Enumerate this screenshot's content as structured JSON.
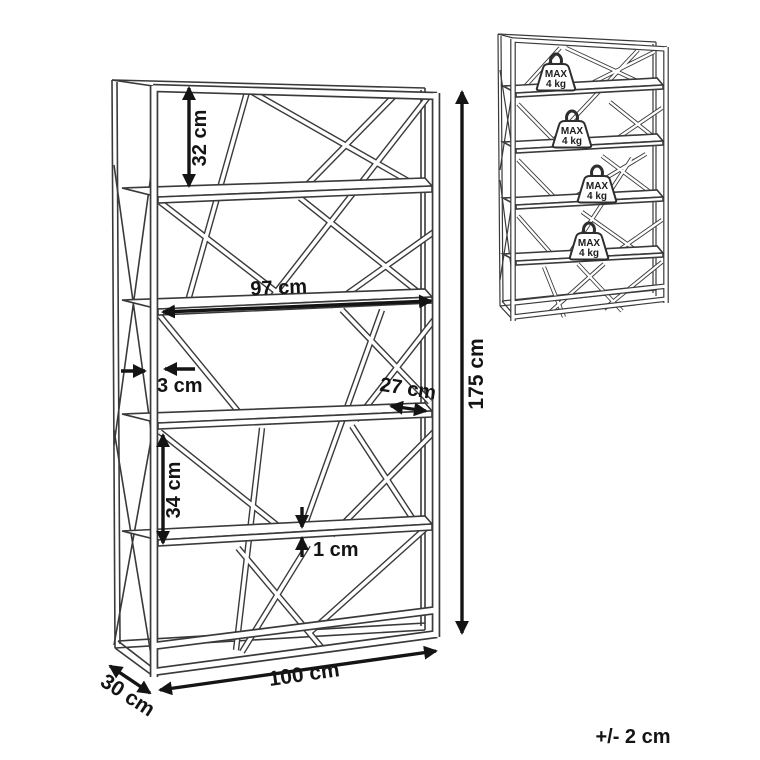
{
  "colors": {
    "line": "#3a3a3a",
    "dimension": "#141414",
    "background": "#ffffff"
  },
  "main_diagram": {
    "description": "shelving unit line drawing with dimension arrows",
    "dimensions": {
      "top_shelf_gap": "32 cm",
      "shelf_width": "97 cm",
      "frame_thickness": "3 cm",
      "shelf_depth": "27 cm",
      "lower_shelf_gap": "34 cm",
      "shelf_thickness": "1 cm",
      "height": "175 cm",
      "width": "100 cm",
      "depth": "30 cm"
    }
  },
  "load_diagram": {
    "description": "shelving unit max load per shelf",
    "weights": [
      {
        "line1": "MAX",
        "line2": "4 kg"
      },
      {
        "line1": "MAX",
        "line2": "4 kg"
      },
      {
        "line1": "MAX",
        "line2": "4 kg"
      },
      {
        "line1": "MAX",
        "line2": "4 kg"
      }
    ]
  },
  "footer": {
    "tolerance": "+/- 2 cm"
  }
}
